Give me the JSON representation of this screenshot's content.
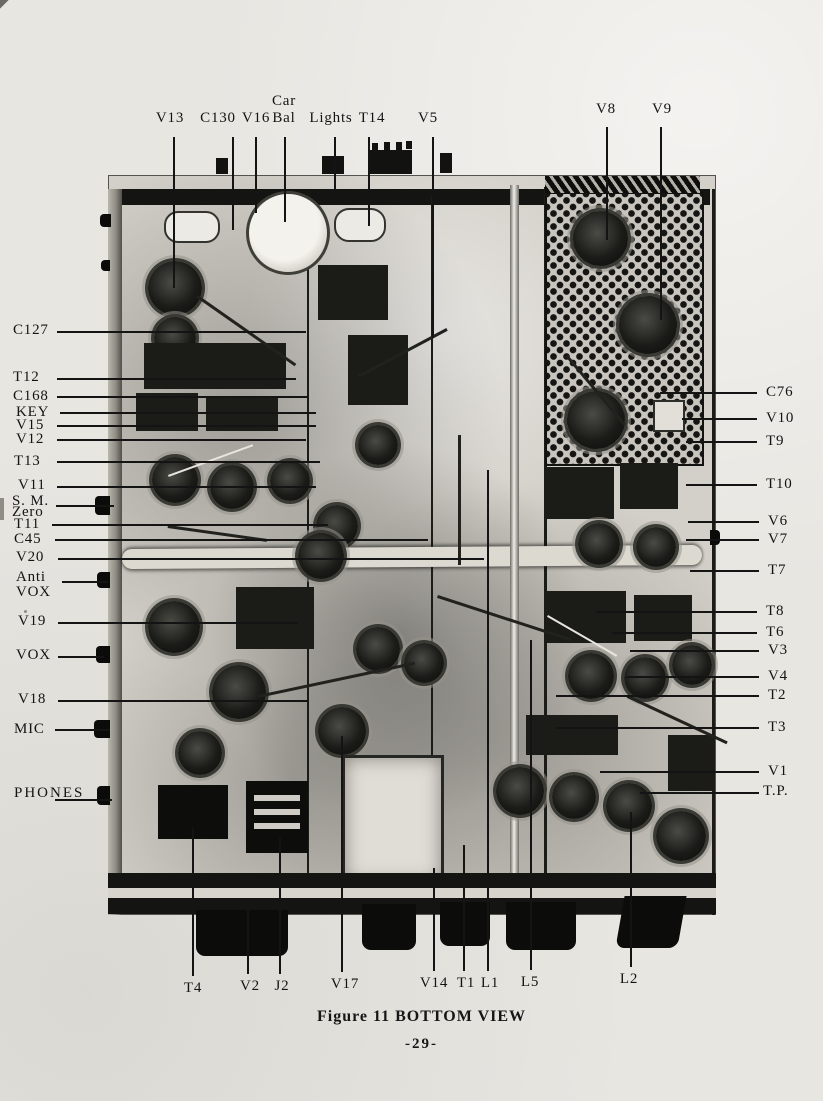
{
  "figure": {
    "caption": "Figure 11 BOTTOM VIEW",
    "page_number": "-29-",
    "photo_subject": "chassis-bottom-view-photograph",
    "colors": {
      "paper": "#e8e6e1",
      "ink": "#141414",
      "photo_base": "#d3d0c9"
    },
    "callouts": {
      "top": [
        {
          "id": "v13",
          "lines": [
            "V13"
          ],
          "tx": 170,
          "ty": 110,
          "line": {
            "x1": 173,
            "y1": 137,
            "x2": 173,
            "y2": 288
          }
        },
        {
          "id": "c130",
          "lines": [
            "C130"
          ],
          "tx": 218,
          "ty": 110,
          "line": {
            "x1": 232,
            "y1": 137,
            "x2": 232,
            "y2": 230
          }
        },
        {
          "id": "v16",
          "lines": [
            "V16"
          ],
          "tx": 256,
          "ty": 110,
          "line": {
            "x1": 255,
            "y1": 137,
            "x2": 255,
            "y2": 213
          }
        },
        {
          "id": "car-bal",
          "lines": [
            "Car",
            "Bal"
          ],
          "tx": 284,
          "ty": 93,
          "lh": 17,
          "line": {
            "x1": 284,
            "y1": 137,
            "x2": 284,
            "y2": 222
          }
        },
        {
          "id": "lights",
          "lines": [
            "Lights"
          ],
          "tx": 331,
          "ty": 110,
          "line": {
            "x1": 334,
            "y1": 137,
            "x2": 334,
            "y2": 203
          }
        },
        {
          "id": "t14",
          "lines": [
            "T14"
          ],
          "tx": 372,
          "ty": 110,
          "line": {
            "x1": 368,
            "y1": 137,
            "x2": 368,
            "y2": 226
          }
        },
        {
          "id": "v5",
          "lines": [
            "V5"
          ],
          "tx": 428,
          "ty": 110,
          "line": {
            "x1": 432,
            "y1": 137,
            "x2": 432,
            "y2": 338
          }
        },
        {
          "id": "v8",
          "lines": [
            "V8"
          ],
          "tx": 606,
          "ty": 101,
          "line": {
            "x1": 606,
            "y1": 127,
            "x2": 606,
            "y2": 240
          }
        },
        {
          "id": "v9",
          "lines": [
            "V9"
          ],
          "tx": 662,
          "ty": 101,
          "line": {
            "x1": 660,
            "y1": 127,
            "x2": 660,
            "y2": 320
          }
        }
      ],
      "left": [
        {
          "id": "c127",
          "lines": [
            "C127"
          ],
          "tx": 13,
          "ty": 322,
          "line": {
            "x1": 57,
            "y1": 331,
            "x2": 306,
            "y2": 331
          }
        },
        {
          "id": "t12",
          "lines": [
            "T12"
          ],
          "tx": 13,
          "ty": 369,
          "line": {
            "x1": 57,
            "y1": 378,
            "x2": 296,
            "y2": 378
          }
        },
        {
          "id": "c168",
          "lines": [
            "C168"
          ],
          "tx": 13,
          "ty": 388,
          "line": {
            "x1": 57,
            "y1": 396,
            "x2": 308,
            "y2": 396
          }
        },
        {
          "id": "key",
          "lines": [
            "KEY"
          ],
          "tx": 16,
          "ty": 404,
          "line": {
            "x1": 60,
            "y1": 412,
            "x2": 316,
            "y2": 412
          }
        },
        {
          "id": "v15",
          "lines": [
            "V15"
          ],
          "tx": 16,
          "ty": 417,
          "line": {
            "x1": 57,
            "y1": 425,
            "x2": 316,
            "y2": 425
          }
        },
        {
          "id": "v12",
          "lines": [
            "V12"
          ],
          "tx": 16,
          "ty": 431,
          "line": {
            "x1": 57,
            "y1": 439,
            "x2": 306,
            "y2": 439
          }
        },
        {
          "id": "t13",
          "lines": [
            "T13"
          ],
          "tx": 14,
          "ty": 453,
          "line": {
            "x1": 57,
            "y1": 461,
            "x2": 320,
            "y2": 461
          }
        },
        {
          "id": "v11",
          "lines": [
            "V11"
          ],
          "tx": 18,
          "ty": 477,
          "line": {
            "x1": 57,
            "y1": 486,
            "x2": 316,
            "y2": 486
          }
        },
        {
          "id": "sm-zero",
          "lines": [
            "S. M.",
            "Zero"
          ],
          "tx": 12,
          "ty": 496,
          "lh": 11,
          "line": {
            "x1": 56,
            "y1": 505,
            "x2": 114,
            "y2": 505
          }
        },
        {
          "id": "t11",
          "lines": [
            "T11"
          ],
          "tx": 14,
          "ty": 516,
          "line": {
            "x1": 52,
            "y1": 524,
            "x2": 328,
            "y2": 524
          }
        },
        {
          "id": "c45",
          "lines": [
            "C45"
          ],
          "tx": 14,
          "ty": 531,
          "line": {
            "x1": 55,
            "y1": 539,
            "x2": 428,
            "y2": 539
          }
        },
        {
          "id": "v20",
          "lines": [
            "V20"
          ],
          "tx": 16,
          "ty": 549,
          "line": {
            "x1": 58,
            "y1": 558,
            "x2": 484,
            "y2": 558
          }
        },
        {
          "id": "anti-vox",
          "lines": [
            "Anti",
            "VOX"
          ],
          "tx": 16,
          "ty": 570,
          "lh": 15,
          "line": {
            "x1": 62,
            "y1": 581,
            "x2": 108,
            "y2": 581
          }
        },
        {
          "id": "v19",
          "lines": [
            "V19"
          ],
          "tx": 18,
          "ty": 613,
          "line": {
            "x1": 58,
            "y1": 622,
            "x2": 298,
            "y2": 622
          }
        },
        {
          "id": "vox",
          "lines": [
            "VOX"
          ],
          "tx": 16,
          "ty": 647,
          "line": {
            "x1": 58,
            "y1": 656,
            "x2": 104,
            "y2": 656
          }
        },
        {
          "id": "v18",
          "lines": [
            "V18"
          ],
          "tx": 18,
          "ty": 691,
          "line": {
            "x1": 58,
            "y1": 700,
            "x2": 308,
            "y2": 700
          }
        },
        {
          "id": "mic",
          "lines": [
            "MIC"
          ],
          "tx": 14,
          "ty": 721,
          "line": {
            "x1": 55,
            "y1": 729,
            "x2": 110,
            "y2": 729
          }
        },
        {
          "id": "phones",
          "lines": [
            "PHONES"
          ],
          "tx": 14,
          "ty": 785,
          "line": {
            "x1": 55,
            "y1": 799,
            "x2": 112,
            "y2": 799
          }
        }
      ],
      "right": [
        {
          "id": "c76",
          "lines": [
            "C76"
          ],
          "tx": 766,
          "ty": 384,
          "line": {
            "x1": 660,
            "y1": 392,
            "x2": 757,
            "y2": 392
          }
        },
        {
          "id": "v10",
          "lines": [
            "V10"
          ],
          "tx": 766,
          "ty": 410,
          "line": {
            "x1": 682,
            "y1": 418,
            "x2": 757,
            "y2": 418
          }
        },
        {
          "id": "t9",
          "lines": [
            "T9"
          ],
          "tx": 766,
          "ty": 433,
          "line": {
            "x1": 686,
            "y1": 441,
            "x2": 757,
            "y2": 441
          }
        },
        {
          "id": "t10",
          "lines": [
            "T10"
          ],
          "tx": 766,
          "ty": 476,
          "line": {
            "x1": 686,
            "y1": 484,
            "x2": 757,
            "y2": 484
          }
        },
        {
          "id": "v6",
          "lines": [
            "V6"
          ],
          "tx": 768,
          "ty": 513,
          "line": {
            "x1": 688,
            "y1": 521,
            "x2": 759,
            "y2": 521
          }
        },
        {
          "id": "v7",
          "lines": [
            "V7"
          ],
          "tx": 768,
          "ty": 531,
          "line": {
            "x1": 686,
            "y1": 539,
            "x2": 759,
            "y2": 539
          }
        },
        {
          "id": "t7",
          "lines": [
            "T7"
          ],
          "tx": 768,
          "ty": 562,
          "line": {
            "x1": 690,
            "y1": 570,
            "x2": 759,
            "y2": 570
          }
        },
        {
          "id": "t8",
          "lines": [
            "T8"
          ],
          "tx": 766,
          "ty": 603,
          "line": {
            "x1": 596,
            "y1": 611,
            "x2": 757,
            "y2": 611
          }
        },
        {
          "id": "t6",
          "lines": [
            "T6"
          ],
          "tx": 766,
          "ty": 624,
          "line": {
            "x1": 612,
            "y1": 632,
            "x2": 757,
            "y2": 632
          }
        },
        {
          "id": "v3",
          "lines": [
            "V3"
          ],
          "tx": 768,
          "ty": 642,
          "line": {
            "x1": 630,
            "y1": 650,
            "x2": 759,
            "y2": 650
          }
        },
        {
          "id": "v4",
          "lines": [
            "V4"
          ],
          "tx": 768,
          "ty": 668,
          "line": {
            "x1": 626,
            "y1": 676,
            "x2": 759,
            "y2": 676
          }
        },
        {
          "id": "t2",
          "lines": [
            "T2"
          ],
          "tx": 768,
          "ty": 687,
          "line": {
            "x1": 556,
            "y1": 695,
            "x2": 759,
            "y2": 695
          }
        },
        {
          "id": "t3",
          "lines": [
            "T3"
          ],
          "tx": 768,
          "ty": 719,
          "line": {
            "x1": 556,
            "y1": 727,
            "x2": 759,
            "y2": 727
          }
        },
        {
          "id": "v1",
          "lines": [
            "V1"
          ],
          "tx": 768,
          "ty": 763,
          "line": {
            "x1": 600,
            "y1": 771,
            "x2": 759,
            "y2": 771
          }
        },
        {
          "id": "tp",
          "lines": [
            "T.P."
          ],
          "tx": 763,
          "ty": 783,
          "line": {
            "x1": 640,
            "y1": 792,
            "x2": 759,
            "y2": 792
          }
        }
      ],
      "bottom": [
        {
          "id": "t4",
          "lines": [
            "T4"
          ],
          "tx": 193,
          "ty": 980,
          "line": {
            "x1": 192,
            "y1": 828,
            "x2": 192,
            "y2": 976
          }
        },
        {
          "id": "v2",
          "lines": [
            "V2"
          ],
          "tx": 250,
          "ty": 978,
          "line": {
            "x1": 247,
            "y1": 898,
            "x2": 247,
            "y2": 974
          }
        },
        {
          "id": "j2",
          "lines": [
            "J2"
          ],
          "tx": 282,
          "ty": 978,
          "line": {
            "x1": 279,
            "y1": 838,
            "x2": 279,
            "y2": 974
          }
        },
        {
          "id": "v17",
          "lines": [
            "V17"
          ],
          "tx": 345,
          "ty": 976,
          "line": {
            "x1": 341,
            "y1": 736,
            "x2": 341,
            "y2": 972
          }
        },
        {
          "id": "v14",
          "lines": [
            "V14"
          ],
          "tx": 434,
          "ty": 975,
          "line": {
            "x1": 433,
            "y1": 868,
            "x2": 433,
            "y2": 971
          }
        },
        {
          "id": "t1",
          "lines": [
            "T1"
          ],
          "tx": 466,
          "ty": 975,
          "line": {
            "x1": 463,
            "y1": 845,
            "x2": 463,
            "y2": 971
          }
        },
        {
          "id": "l1",
          "lines": [
            "L1"
          ],
          "tx": 490,
          "ty": 975,
          "line": {
            "x1": 487,
            "y1": 470,
            "x2": 487,
            "y2": 971
          }
        },
        {
          "id": "l5",
          "lines": [
            "L5"
          ],
          "tx": 530,
          "ty": 974,
          "line": {
            "x1": 530,
            "y1": 640,
            "x2": 530,
            "y2": 970
          }
        },
        {
          "id": "l2",
          "lines": [
            "L2"
          ],
          "tx": 629,
          "ty": 971,
          "line": {
            "x1": 630,
            "y1": 812,
            "x2": 630,
            "y2": 967
          }
        }
      ]
    }
  }
}
